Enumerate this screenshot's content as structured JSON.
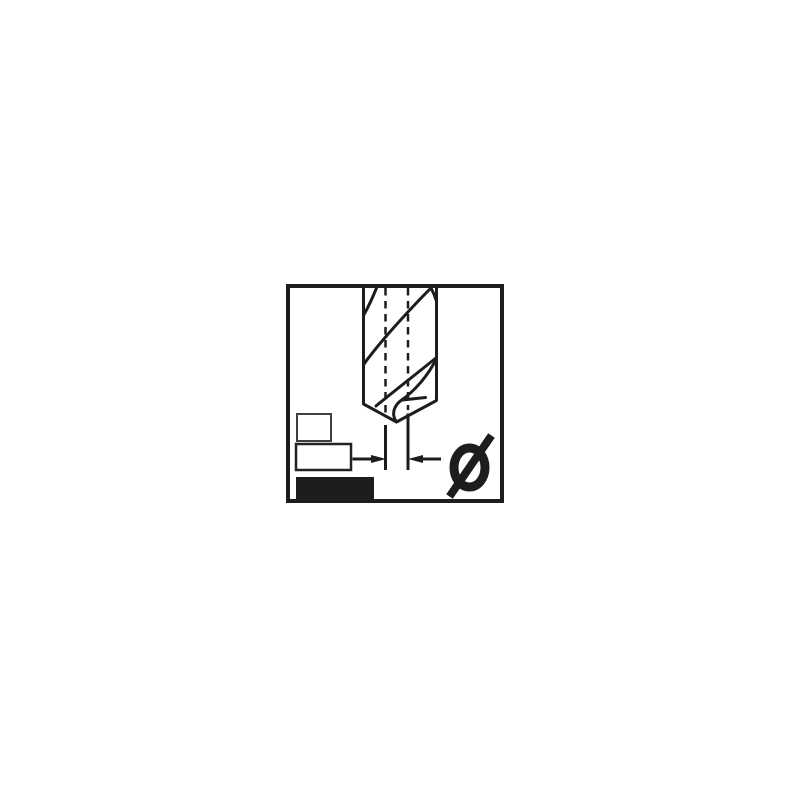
{
  "page": {
    "background_color": "#ffffff"
  },
  "pictogram": {
    "subject": "twist-drill-bit-diameter",
    "diameter_symbol": "Ø",
    "line_color": "#1d1d1b",
    "frame": {
      "border_color": "#1d1d1b",
      "background_color": "#ffffff"
    },
    "indicator_boxes": [
      {
        "style": "outlined",
        "fill": "#ffffff",
        "border": "#3f3f3f"
      },
      {
        "style": "outlined",
        "fill": "#ffffff",
        "border": "#232323"
      },
      {
        "style": "filled",
        "fill": "#1d1d1b",
        "border": "#1d1d1b"
      }
    ]
  }
}
